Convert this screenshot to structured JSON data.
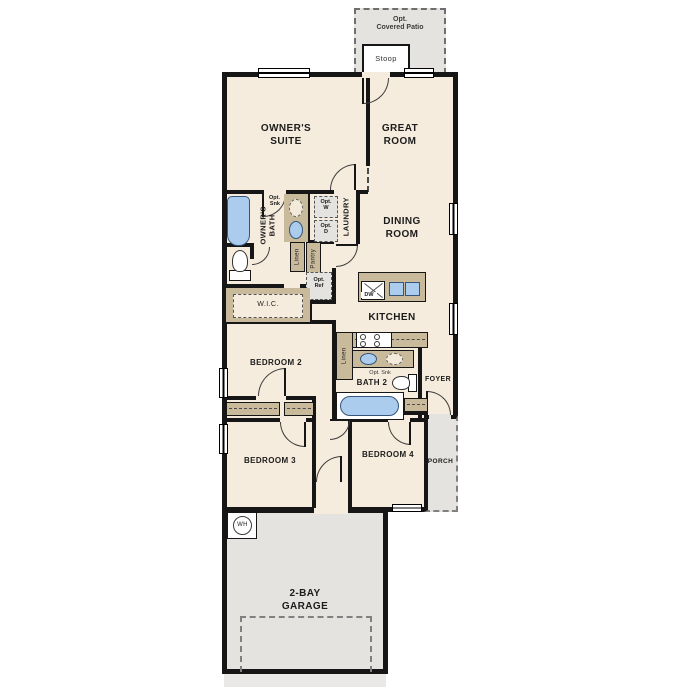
{
  "colors": {
    "floor": "#f6ecdd",
    "wall": "#161616",
    "exterior_gray": "#e4e3e0",
    "counter_tan": "#c9ba9b",
    "fixture_blue": "#abccec"
  },
  "labels": {
    "patio_l1": "Opt.",
    "patio_l2": "Covered Patio",
    "stoop": "Stoop",
    "owners_suite_l1": "OWNER'S",
    "owners_suite_l2": "SUITE",
    "great_room_l1": "GREAT",
    "great_room_l2": "ROOM",
    "owners_bath_l1": "OWNER'S",
    "owners_bath_l2": "BATH",
    "opt_sink_l1": "Opt.",
    "opt_sink_l2": "Snk",
    "laundry": "LAUNDRY",
    "opt_washer_l1": "Opt.",
    "opt_washer_l2": "W",
    "opt_dryer_l1": "Opt.",
    "opt_dryer_l2": "D",
    "linen_owners": "Linen",
    "pantry": "Pantry",
    "wic": "W.I.C.",
    "opt_ref_l1": "Opt.",
    "opt_ref_l2": "Ref",
    "dining_l1": "DINING",
    "dining_l2": "ROOM",
    "kitchen": "KITCHEN",
    "dishwasher": "DW",
    "linen_kitchen": "Linen",
    "bedroom2": "BEDROOM 2",
    "bedroom3": "BEDROOM 3",
    "bedroom4": "BEDROOM 4",
    "bath2": "BATH 2",
    "opt_sink_bath2": "Opt. Snk",
    "foyer": "FOYER",
    "porch": "PORCH",
    "water_heater": "WH",
    "garage_l1": "2-BAY",
    "garage_l2": "GARAGE"
  }
}
